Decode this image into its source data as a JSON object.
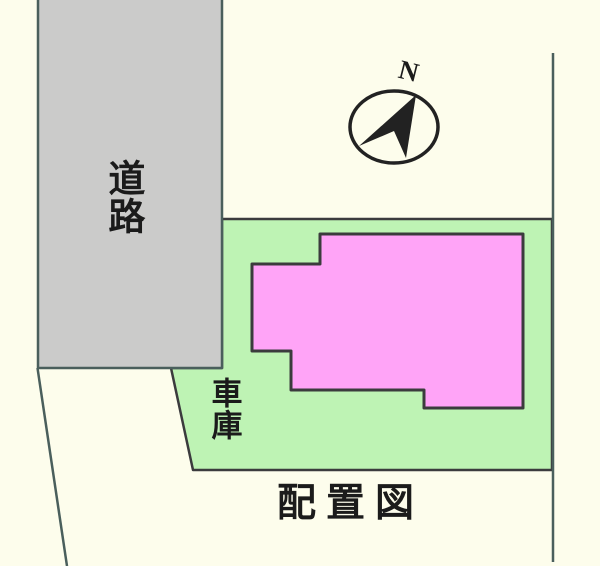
{
  "title": "配置図",
  "labels": {
    "road": "道路",
    "garage": "車庫",
    "plan_title": "配置図",
    "north": "N"
  },
  "colors": {
    "background": "#fdfdec",
    "road_fill": "#cbcbca",
    "lot_fill": "#bef3b4",
    "building_fill": "#ffa4f7",
    "outline_dark": "#3b3b3d",
    "boundary_teal": "#4a5f5c",
    "compass_ink": "#222222",
    "text": "#1b1b1b"
  }
}
